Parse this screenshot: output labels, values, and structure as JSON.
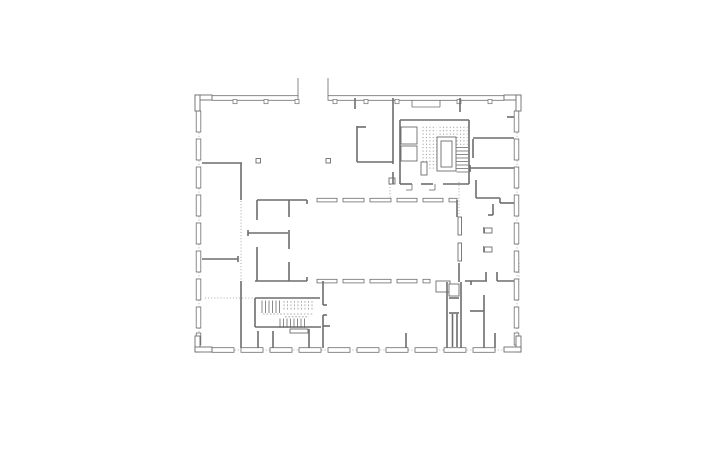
{
  "drawing": {
    "kind": "architectural-floor-plan",
    "canvas": {
      "width": 720,
      "height": 450
    },
    "colors": {
      "background": "#ffffff",
      "line": "#6d6d6d",
      "light": "#9b9b9b",
      "dot": "#8f8f8f"
    },
    "layers": [
      {
        "key": "dotted",
        "type": "line",
        "stroke": "dot",
        "width": 0.8,
        "dash": "1,2.1"
      },
      {
        "key": "hatch",
        "type": "rect",
        "fill": "url(#dotgrid)",
        "stroke": "none",
        "width": 0
      },
      {
        "key": "windows",
        "type": "rect",
        "fill": "#ffffff",
        "stroke": "line",
        "width": 0.8
      },
      {
        "key": "corners",
        "type": "rect",
        "fill": "#ffffff",
        "stroke": "line",
        "width": 0.9
      },
      {
        "key": "posts",
        "type": "rect",
        "fill": "#ffffff",
        "stroke": "line",
        "width": 0.7
      },
      {
        "key": "boxes",
        "type": "rect",
        "fill": "#ffffff",
        "stroke": "line",
        "width": 0.9
      },
      {
        "key": "walls",
        "type": "line",
        "stroke": "line",
        "width": 1.6
      },
      {
        "key": "thin",
        "type": "line",
        "stroke": "line",
        "width": 0.8
      },
      {
        "key": "dashedl",
        "type": "line",
        "stroke": "light",
        "width": 0.8,
        "dash": "1.7,1.7"
      }
    ],
    "dotted": [
      [
        199,
        111,
        199,
        347
      ],
      [
        517,
        111,
        517,
        347
      ],
      [
        213,
        350,
        503,
        350
      ],
      [
        241,
        201,
        241,
        280
      ],
      [
        205,
        298,
        253,
        298
      ],
      [
        390,
        184,
        390,
        199
      ],
      [
        459,
        182,
        459,
        216
      ],
      [
        519,
        263,
        519,
        280
      ]
    ],
    "hatch": [
      [
        420.5,
        125,
        16,
        46
      ],
      [
        438,
        125,
        18,
        11
      ],
      [
        456.5,
        125,
        11,
        21
      ]
    ],
    "windows": [
      [
        196.2,
        111,
        4.6,
        21
      ],
      [
        196.2,
        139,
        4.6,
        21
      ],
      [
        196.2,
        167,
        4.6,
        21
      ],
      [
        196.2,
        195,
        4.6,
        21
      ],
      [
        196.2,
        223,
        4.6,
        21
      ],
      [
        196.2,
        251,
        4.6,
        21
      ],
      [
        196.2,
        279,
        4.6,
        21
      ],
      [
        196.2,
        307,
        4.6,
        21
      ],
      [
        196.2,
        333,
        4.6,
        12
      ],
      [
        514.2,
        111,
        4.6,
        21
      ],
      [
        514.2,
        139,
        4.6,
        21
      ],
      [
        514.2,
        167,
        4.6,
        21
      ],
      [
        514.2,
        195,
        4.6,
        21
      ],
      [
        514.2,
        223,
        4.6,
        21
      ],
      [
        514.2,
        251,
        4.6,
        21
      ],
      [
        514.2,
        279,
        4.6,
        21
      ],
      [
        514.2,
        307,
        4.6,
        21
      ],
      [
        514.2,
        333,
        4.6,
        12
      ],
      [
        212,
        95.7,
        86,
        4.6
      ],
      [
        328,
        95.7,
        176,
        4.6
      ],
      [
        212,
        347.7,
        22,
        4.6
      ],
      [
        241,
        347.7,
        22,
        4.6
      ],
      [
        270,
        347.7,
        22,
        4.6
      ],
      [
        299,
        347.7,
        22,
        4.6
      ],
      [
        328,
        347.7,
        22,
        4.6
      ],
      [
        357,
        347.7,
        22,
        4.6
      ],
      [
        386,
        347.7,
        22,
        4.6
      ],
      [
        415,
        347.7,
        22,
        4.6
      ],
      [
        444,
        347.7,
        22,
        4.6
      ],
      [
        473,
        347.7,
        22,
        4.6
      ],
      [
        317,
        198.3,
        20,
        3.6
      ],
      [
        343,
        198.3,
        21,
        3.6
      ],
      [
        370,
        198.3,
        21,
        3.6
      ],
      [
        397,
        198.3,
        20,
        3.6
      ],
      [
        423,
        198.3,
        20,
        3.6
      ],
      [
        449,
        198.3,
        8,
        3.6
      ],
      [
        317,
        279.3,
        20,
        3.6
      ],
      [
        343,
        279.3,
        21,
        3.6
      ],
      [
        370,
        279.3,
        21,
        3.6
      ],
      [
        397,
        279.3,
        20,
        3.6
      ],
      [
        423,
        279.3,
        7,
        3.6
      ]
    ],
    "corners": [
      [
        195,
        95,
        17,
        5
      ],
      [
        195,
        95,
        5,
        16
      ],
      [
        504,
        95,
        17,
        5
      ],
      [
        516,
        95,
        5,
        16
      ],
      [
        195,
        336,
        5,
        16
      ],
      [
        195,
        347,
        17,
        5
      ],
      [
        516,
        336,
        5,
        16
      ],
      [
        504,
        347,
        17,
        5
      ]
    ],
    "posts": [
      [
        233,
        99.5,
        4,
        4.2
      ],
      [
        264,
        99.5,
        4,
        4.2
      ],
      [
        295,
        99.5,
        4,
        4.2
      ],
      [
        333,
        99.5,
        4,
        4.2
      ],
      [
        364,
        99.5,
        4,
        4.2
      ],
      [
        395,
        99.5,
        4,
        4.2
      ],
      [
        457,
        99.5,
        4,
        4.2
      ],
      [
        488,
        99.5,
        4,
        4.2
      ]
    ],
    "boxes": [
      [
        401,
        127,
        16,
        17
      ],
      [
        401,
        146,
        16,
        15
      ],
      [
        421,
        162,
        6,
        13
      ],
      [
        437,
        137,
        19,
        34
      ],
      [
        441,
        141,
        11,
        26
      ],
      [
        436,
        281,
        14,
        11
      ],
      [
        449,
        284,
        10,
        12
      ],
      [
        290,
        329,
        18,
        4
      ],
      [
        256,
        158.5,
        4.5,
        4.5
      ],
      [
        326,
        158.5,
        4.5,
        4.5
      ],
      [
        389,
        178,
        6,
        6
      ],
      [
        458,
        217,
        3.5,
        18
      ],
      [
        458,
        243,
        3.5,
        18
      ],
      [
        484.5,
        228,
        7.5,
        5
      ],
      [
        484.5,
        247,
        7.5,
        5
      ]
    ],
    "walls": [
      [
        202,
        163,
        242,
        163
      ],
      [
        241,
        163,
        241,
        200
      ],
      [
        202,
        259,
        238,
        259
      ],
      [
        238,
        256,
        238,
        262
      ],
      [
        241,
        281,
        241,
        348
      ],
      [
        355,
        98,
        355,
        109
      ],
      [
        460,
        98,
        460,
        112
      ],
      [
        357,
        126,
        357,
        162
      ],
      [
        357,
        127,
        366,
        127
      ],
      [
        357,
        162,
        393,
        162
      ],
      [
        393,
        98,
        393,
        164
      ],
      [
        393,
        172,
        393,
        184
      ],
      [
        400,
        120,
        400,
        184
      ],
      [
        400,
        120,
        469,
        120
      ],
      [
        469,
        120,
        469,
        184
      ],
      [
        400,
        184,
        412,
        184
      ],
      [
        421,
        184,
        433,
        184
      ],
      [
        443,
        184,
        469,
        184
      ],
      [
        473,
        138,
        514,
        138
      ],
      [
        473,
        139,
        473,
        158
      ],
      [
        470,
        168,
        514,
        168
      ],
      [
        470,
        165,
        470,
        172
      ],
      [
        476,
        180,
        476,
        198
      ],
      [
        476,
        198,
        500,
        198
      ],
      [
        500,
        198,
        500,
        203
      ],
      [
        500,
        203,
        514,
        203
      ],
      [
        493,
        204,
        493,
        215
      ],
      [
        488,
        215,
        493,
        215
      ],
      [
        507,
        117,
        514,
        117
      ],
      [
        257,
        200,
        307,
        200
      ],
      [
        307,
        200,
        307,
        204
      ],
      [
        257,
        200,
        257,
        220
      ],
      [
        248,
        233,
        288,
        233
      ],
      [
        248,
        230,
        248,
        236
      ],
      [
        257,
        247,
        257,
        281
      ],
      [
        289,
        200,
        289,
        217
      ],
      [
        289,
        230,
        289,
        249
      ],
      [
        289,
        262,
        289,
        281
      ],
      [
        255,
        281,
        307,
        281
      ],
      [
        307,
        277,
        307,
        281
      ],
      [
        457,
        200,
        457,
        217
      ],
      [
        459,
        263,
        459,
        282
      ],
      [
        323,
        281,
        323,
        305
      ],
      [
        323,
        315,
        323,
        348
      ],
      [
        323,
        305,
        327,
        305
      ],
      [
        323,
        315,
        327,
        315
      ],
      [
        323,
        326,
        330,
        326
      ],
      [
        255,
        298,
        255,
        327
      ],
      [
        255,
        298,
        320,
        298
      ],
      [
        255,
        327,
        321,
        327
      ],
      [
        258,
        331,
        258,
        348
      ],
      [
        273,
        331,
        273,
        348
      ],
      [
        309,
        329,
        309,
        348
      ],
      [
        406,
        333,
        406,
        348
      ],
      [
        447,
        282,
        447,
        348
      ],
      [
        461,
        282,
        461,
        348
      ],
      [
        449,
        298,
        459,
        298
      ],
      [
        449,
        313,
        459,
        313
      ],
      [
        452.5,
        314,
        452.5,
        347
      ],
      [
        457,
        314,
        457,
        347
      ],
      [
        465,
        281,
        487,
        281
      ],
      [
        497,
        281,
        514,
        281
      ],
      [
        486,
        272,
        486,
        281
      ],
      [
        497,
        272,
        497,
        281
      ],
      [
        471,
        281,
        471,
        285
      ],
      [
        484,
        295,
        484,
        348
      ],
      [
        470,
        311,
        484,
        311
      ],
      [
        495,
        333,
        495,
        348
      ]
    ],
    "thin": [
      [
        298,
        78,
        298,
        96
      ],
      [
        328,
        78,
        328,
        96
      ],
      [
        412,
        100,
        412,
        107
      ],
      [
        440,
        100,
        440,
        107
      ],
      [
        412,
        107,
        440,
        107
      ],
      [
        412,
        184,
        412,
        190
      ],
      [
        406,
        190,
        412,
        190
      ],
      [
        435,
        184,
        435,
        190
      ],
      [
        429,
        190,
        435,
        190
      ],
      [
        483.5,
        227,
        483.5,
        233.5
      ],
      [
        483.5,
        246,
        483.5,
        252.5
      ],
      [
        456.5,
        147.5,
        468,
        147.5
      ],
      [
        456.5,
        151,
        468,
        151
      ],
      [
        456.5,
        154.5,
        468,
        154.5
      ],
      [
        456.5,
        158,
        468,
        158
      ],
      [
        456.5,
        161.5,
        468,
        161.5
      ],
      [
        456.5,
        165,
        468,
        165
      ],
      [
        456.5,
        168.5,
        468,
        168.5
      ],
      [
        456.5,
        172,
        468,
        172
      ],
      [
        262,
        300.5,
        262,
        313
      ],
      [
        265.5,
        300.5,
        265.5,
        313
      ],
      [
        269,
        300.5,
        269,
        313
      ],
      [
        272.5,
        300.5,
        272.5,
        313
      ],
      [
        276,
        300.5,
        276,
        313
      ],
      [
        279.5,
        300.5,
        279.5,
        313
      ],
      [
        280,
        318.5,
        280,
        328
      ],
      [
        283.5,
        318.5,
        283.5,
        328
      ],
      [
        287,
        318.5,
        287,
        328
      ],
      [
        290.5,
        318.5,
        290.5,
        328
      ],
      [
        294,
        318.5,
        294,
        328
      ],
      [
        297.5,
        318.5,
        297.5,
        328
      ],
      [
        301,
        318.5,
        301,
        328
      ],
      [
        304.5,
        318.5,
        304.5,
        328
      ]
    ],
    "dashedl": [
      [
        284,
        301,
        284,
        311
      ],
      [
        287.5,
        301,
        287.5,
        311
      ],
      [
        291,
        301,
        291,
        311
      ],
      [
        294.5,
        301,
        294.5,
        311
      ],
      [
        298,
        301,
        298,
        311
      ],
      [
        301.5,
        301,
        301.5,
        311
      ],
      [
        305,
        301,
        305,
        311
      ],
      [
        308.5,
        301,
        308.5,
        311
      ],
      [
        312,
        301,
        312,
        311
      ],
      [
        263,
        314,
        313,
        314
      ],
      [
        285,
        316.8,
        309,
        316.8
      ]
    ]
  }
}
